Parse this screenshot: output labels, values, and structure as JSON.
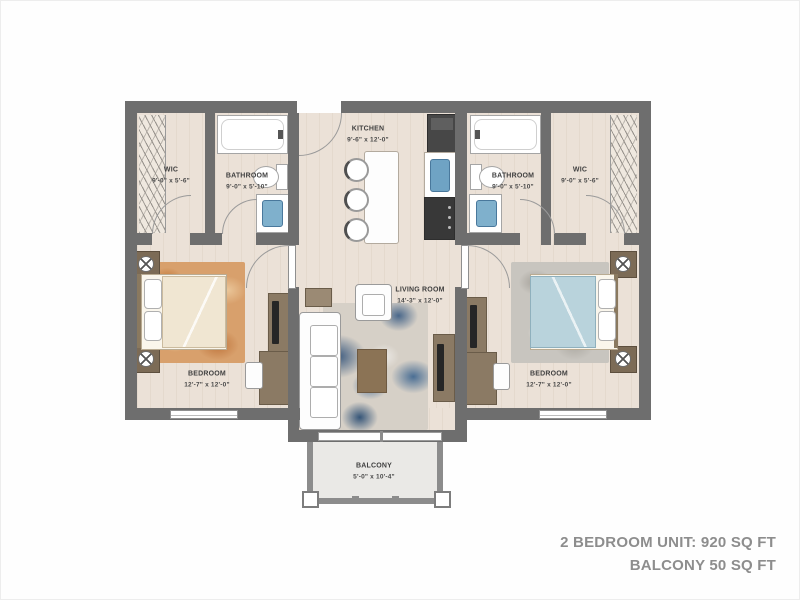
{
  "title_block": {
    "line1": "2 BEDROOM UNIT: 920 SQ FT",
    "line2": "BALCONY 50 SQ FT"
  },
  "rooms": {
    "wic_left": {
      "name": "WIC",
      "dims": "9'-0\" x 5'-6\""
    },
    "bathroom_left": {
      "name": "BATHROOM",
      "dims": "9'-0\" x 5'-10\""
    },
    "kitchen": {
      "name": "KITCHEN",
      "dims": "9'-6\" x 12'-0\""
    },
    "bathroom_right": {
      "name": "BATHROOM",
      "dims": "9'-0\" x 5'-10\""
    },
    "wic_right": {
      "name": "WIC",
      "dims": "9'-0\" x 5'-6\""
    },
    "bedroom_left": {
      "name": "BEDROOM",
      "dims": "12'-7\" x 12'-0\""
    },
    "living_room": {
      "name": "LIVING ROOM",
      "dims": "14'-3\" x 12'-0\""
    },
    "bedroom_right": {
      "name": "BEDROOM",
      "dims": "12'-7\" x 12'-0\""
    },
    "balcony": {
      "name": "BALCONY",
      "dims": "5'-0\" x 10'-4\""
    }
  },
  "colors": {
    "wall": "#6e6e6e",
    "balcony_wall": "#8c8c8c",
    "floor": "#ebe1d7",
    "balcony_floor": "#eae9e6",
    "sink_blue": "#7fb0cc",
    "rug_blue": "#3c5a7e",
    "rug_orange": "#d8a06c",
    "annotation_gray": "#8d8d8d"
  }
}
